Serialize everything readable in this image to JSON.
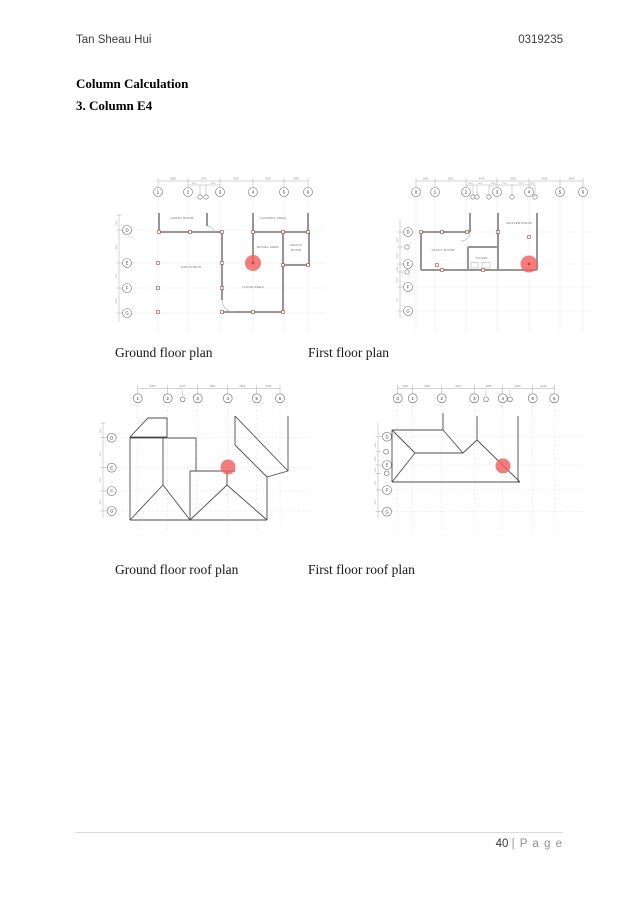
{
  "document": {
    "author": "Tan Sheau Hui",
    "student_id": "0319235",
    "section_title": "Column Calculation",
    "subsection_title": "3. Column E4",
    "footer_page_number": "40 ",
    "footer_page_suffix": "| P a g e"
  },
  "colors": {
    "highlight_circle": "#f25f5f",
    "column_marker": "#c0504d",
    "wall": "#969696",
    "roof_line": "#4d4d4d"
  },
  "figures": {
    "ground_floor": {
      "caption": "Ground floor plan",
      "grid_columns": [
        "1",
        "2",
        "3",
        "4",
        "5",
        "6"
      ],
      "grid_rows": [
        "D",
        "E",
        "F",
        "G"
      ],
      "rooms": {
        "guest": "GUEST ROOM",
        "laundry": "LAUNDRY AREA",
        "dining": "DINING AREA",
        "maids_line1": "MAID'S",
        "maids_line2": "ROOM",
        "car_porch": "CAR PORCH",
        "living": "LIVING AREA"
      },
      "dims_top": [
        "3925",
        "4475",
        "3925",
        "3925",
        "3440"
      ],
      "dims_top_sub": [
        "1625",
        "2850"
      ],
      "dims_left": [
        "3000",
        "4000",
        "3075",
        "3000"
      ]
    },
    "first_floor": {
      "caption": "First floor plan",
      "grid_columns": [
        "0",
        "1",
        "2",
        "3",
        "4",
        "5",
        "6"
      ],
      "grid_rows": [
        "D",
        "E",
        "F",
        "G"
      ],
      "rooms": {
        "study": "STUDY ROOM",
        "toilet": "TOILET",
        "master": "MASTER ROOM"
      },
      "dims_top": [
        "2060",
        "3925",
        "4475",
        "3925",
        "3925",
        "3440"
      ],
      "dims_top_sub": [
        "2850",
        "1625",
        "1425",
        "1700",
        "3225",
        "2325"
      ],
      "dims_left": [
        "1950",
        "2850",
        "1150",
        "2325",
        "3075"
      ]
    },
    "ground_floor_roof": {
      "caption": "Ground floor roof plan"
    },
    "first_floor_roof": {
      "caption": "First floor roof plan"
    }
  }
}
